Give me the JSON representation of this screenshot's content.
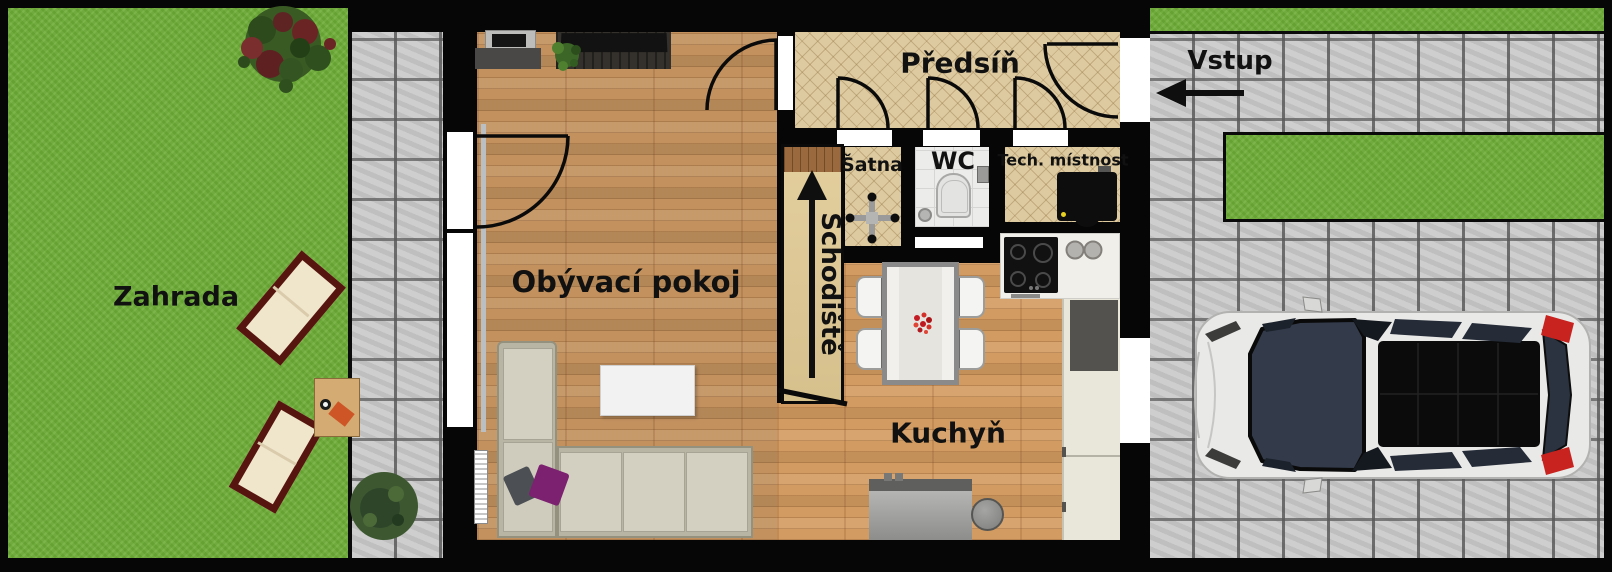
{
  "plan": {
    "rooms": {
      "garden": "Zahrada",
      "living_room": "Obývací pokoj",
      "hallway": "Předsíň",
      "closet": "Šatna",
      "wc": "WC",
      "utility_room": "Tech. místnost",
      "staircase": "Schodiště",
      "kitchen": "Kuchyň"
    },
    "entrance_label": "Vstup"
  },
  "colors": {
    "wall": "#060606",
    "grass": "#6fae38",
    "pavement": "#c9c9c9",
    "wood_floor": "#c2915e",
    "hallway_carpet": "#ddcaa1",
    "stair_tread": "#dcc795",
    "wc_tile": "#ececea",
    "sofa": "#c9c6b6",
    "car_body": "#e9e9e7",
    "flower_red": "#c41c24",
    "pillow_purple": "#7c2070",
    "table_orange": "#cd5526"
  }
}
